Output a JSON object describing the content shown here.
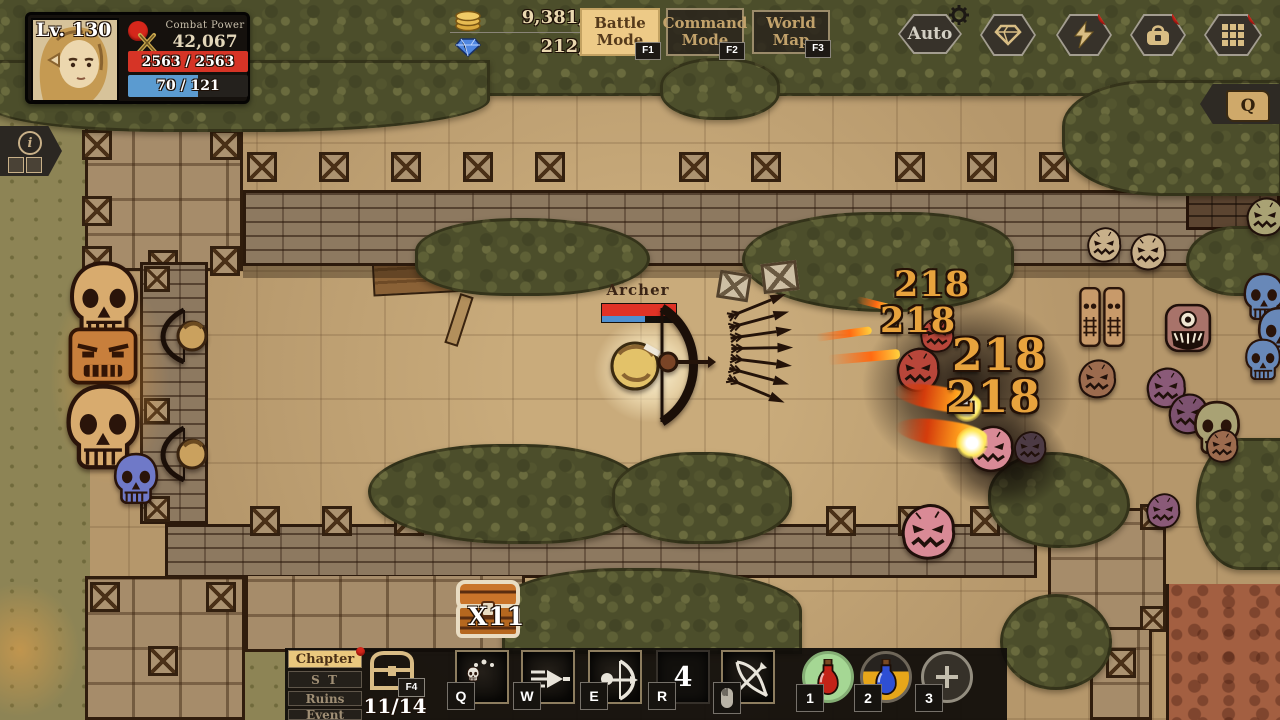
{
  "hud": {
    "player": {
      "level": "Lv. 130",
      "combat_power_label": "Combat Power",
      "combat_power_value": "42,067",
      "hp_text": "2563 / 2563",
      "mp_text": "70 / 121"
    },
    "currency": {
      "gold": "9,381,390",
      "gems": "212,525"
    },
    "modes": [
      {
        "label": "Battle Mode",
        "key": "F1",
        "active": true
      },
      {
        "label": "Command Mode",
        "key": "F2",
        "active": false
      },
      {
        "label": "World Map",
        "key": "F3",
        "active": false
      }
    ],
    "auto_button": {
      "label": "Auto"
    },
    "info_tag": {
      "letter": "i"
    },
    "quest_tag": {
      "letter": "Q"
    }
  },
  "world": {
    "archer": {
      "name": "Archer",
      "hp_pct": 100,
      "mp_pct": 58
    },
    "damage_numbers": [
      "218",
      "218",
      "218",
      "218"
    ],
    "chest": {
      "count_label": "X11"
    }
  },
  "bottom_bar": {
    "menu": [
      {
        "label": "Chapter",
        "active": true,
        "notify": true
      },
      {
        "label": "S T",
        "active": false
      },
      {
        "label": "Ruins",
        "active": false
      },
      {
        "label": "Event",
        "active": false
      }
    ],
    "chest_button": {
      "key": "F4",
      "count": "11/14"
    },
    "skills": [
      {
        "key": "Q",
        "icon": "poison-skull-skill-icon"
      },
      {
        "key": "W",
        "icon": "piercing-shot-skill-icon"
      },
      {
        "key": "E",
        "icon": "archer-volley-skill-icon"
      },
      {
        "key": "R",
        "icon": "empty-slot",
        "count": "4"
      },
      {
        "key": "",
        "icon": "bow-attack-skill-icon mouse-left-button"
      }
    ],
    "potions": [
      {
        "key": "1",
        "state": "ready",
        "type": "red-potion"
      },
      {
        "key": "2",
        "state": "cooldown",
        "type": "blue-potion"
      },
      {
        "key": "3",
        "state": "empty",
        "type": "plus"
      }
    ]
  },
  "icons": {
    "coins-icon": "stacked gold coins",
    "gem-icon": "blue diamond",
    "swords-icon": "crossed swords",
    "gear-icon": "settings gear",
    "lightning-icon": "energy bolt",
    "bag-icon": "inventory bag",
    "grid-icon": "app grid menu",
    "scroll-icon": "quest scroll",
    "info-icon": "information",
    "chest-icon": "treasure chest",
    "mouse-icon": "left mouse button"
  },
  "colors": {
    "accent_tan": "#e9c87f",
    "hp_red": "#d63426",
    "mp_blue": "#5b9bd0",
    "damage_gold": "#e8a33d",
    "alert_red": "#d5271b"
  }
}
